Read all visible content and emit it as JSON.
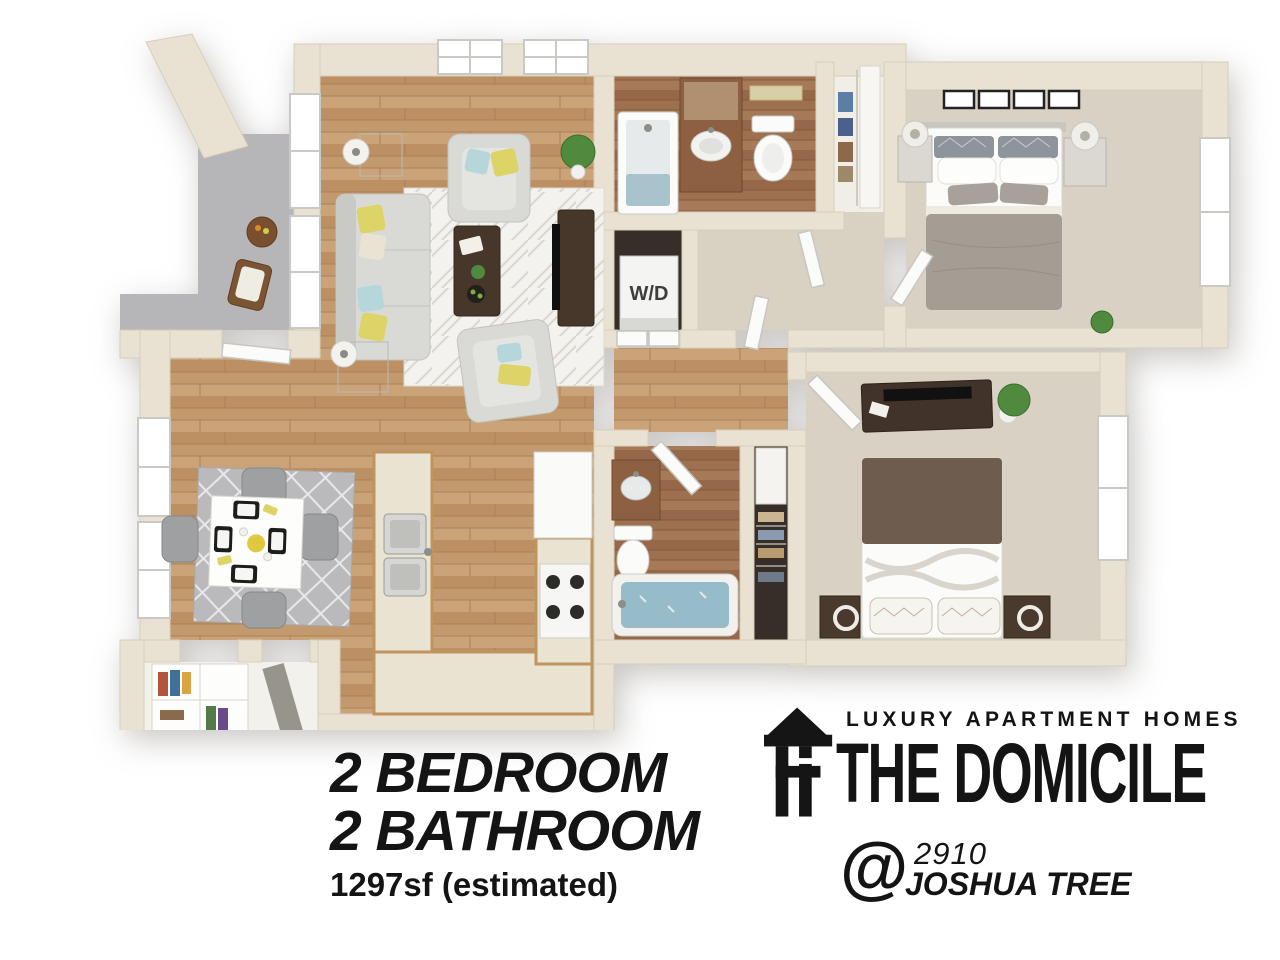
{
  "floor_plan": {
    "type": "3d-top-down-floor-plan",
    "washer_dryer_label": "W/D",
    "rooms": [
      "patio",
      "living-room",
      "dining-room",
      "kitchen",
      "master-bathroom",
      "walk-in-closet",
      "laundry-closet",
      "suite-hall",
      "hallway",
      "master-bedroom",
      "second-bathroom",
      "linen-closet",
      "second-bedroom",
      "entry-closet"
    ]
  },
  "details": {
    "line1": "2 BEDROOM",
    "line2": "2 BATHROOM",
    "sqft": "1297sf (estimated)"
  },
  "branding": {
    "tagline": "LUXURY APARTMENT HOMES",
    "name": "THE DOMICILE",
    "at_symbol": "@",
    "address_number": "2910",
    "address_street": "JOSHUA TREE",
    "logo_icon": "house-arrow-icon"
  },
  "colors": {
    "text": "#141414",
    "wall": "#e9e1d1",
    "wall_edge": "#d8cfba",
    "wood": "#c39a6d",
    "wood_dark": "#9d7150",
    "carpet": "#d9d2c4",
    "suite_tile": "#d9d2c3",
    "concrete": "#b6b5b7",
    "rug_living": "#f4f2ee",
    "rug_dining": "#bababc",
    "sofa_gray": "#d9d9d6",
    "dark_wood": "#47372a",
    "counter": "#e9e4d1",
    "cabinet": "#c1935e",
    "water": "#96bcc9",
    "fixture_white": "#fbfbf9",
    "plant_green": "#4f8a3e",
    "accent_yellow": "#ddd468",
    "accent_blue": "#b5d7db",
    "closet_dark": "#362e27",
    "entry_floor": "#f3f1ec",
    "duvet_gray": "#a49d94",
    "duvet_brown": "#6e5d4e"
  }
}
